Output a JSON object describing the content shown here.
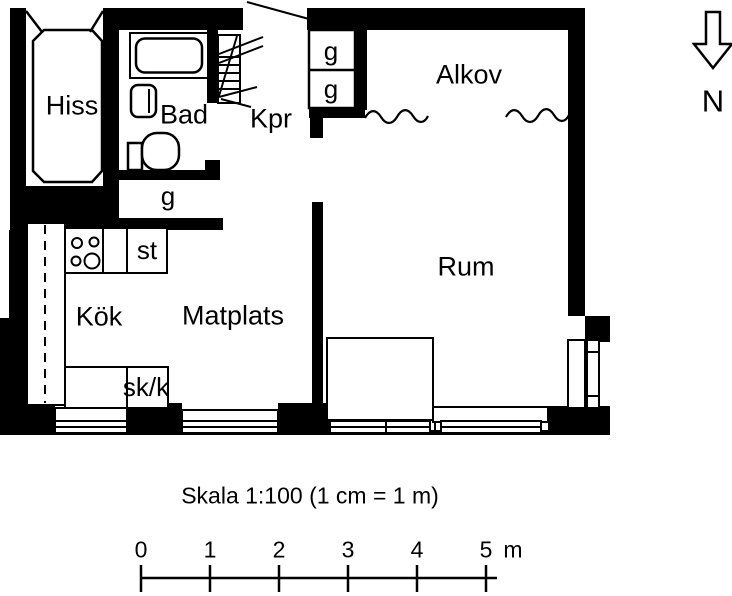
{
  "colors": {
    "ink": "#000000",
    "background": "#ffffff"
  },
  "rooms": {
    "hiss": "Hiss",
    "bad": "Bad",
    "kpr": "Kpr",
    "alkov": "Alkov",
    "rum": "Rum",
    "kok": "Kök",
    "matplats": "Matplats"
  },
  "storage": {
    "hall_closet": "g",
    "alkov_closet_top": "g",
    "alkov_closet_bottom": "g",
    "stove": "st",
    "cupboard": "sk/k"
  },
  "north": {
    "label": "N"
  },
  "scale": {
    "caption": "Skala 1:100 (1 cm = 1 m)",
    "ticks": [
      "0",
      "1",
      "2",
      "3",
      "4",
      "5"
    ],
    "unit": "m"
  }
}
